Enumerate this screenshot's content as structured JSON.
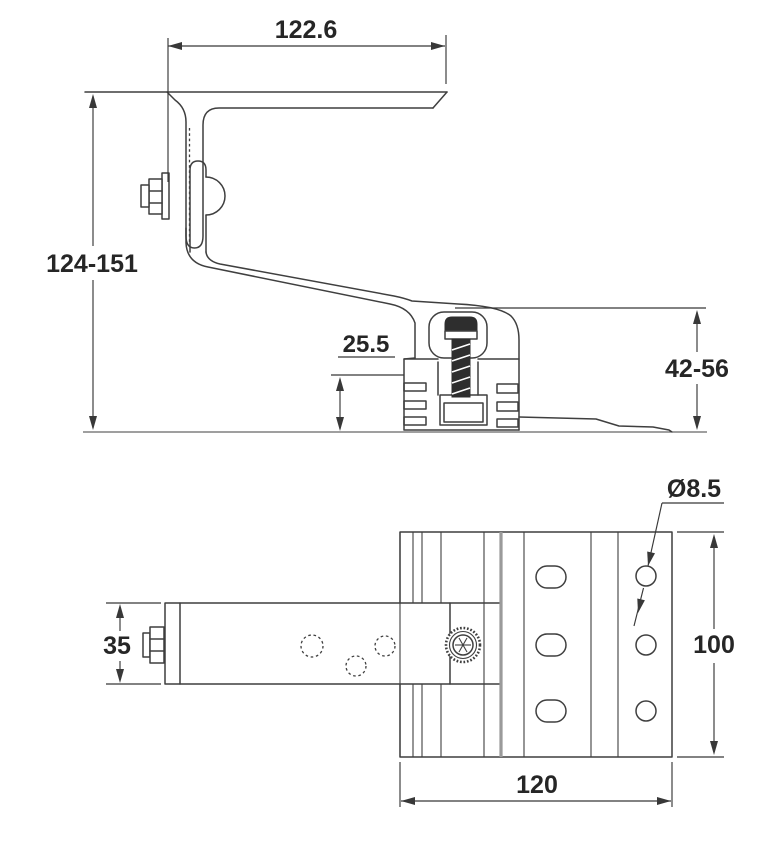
{
  "side_view": {
    "dim_flange_width": "122.6",
    "dim_overall_height": "124-151",
    "dim_base_inset": "25.5",
    "dim_rail_height": "42-56"
  },
  "plan_view": {
    "dim_hole_diameter": "Ø8.5",
    "dim_arm_width": "35",
    "dim_plate_depth": "100",
    "dim_plate_width": "120"
  },
  "colors": {
    "background": "#ffffff",
    "line": "#3f3f3f",
    "dim": "#383838",
    "text": "#262626",
    "bolt": "#2e2e2e",
    "thick_rib": "#9a9a9a"
  }
}
